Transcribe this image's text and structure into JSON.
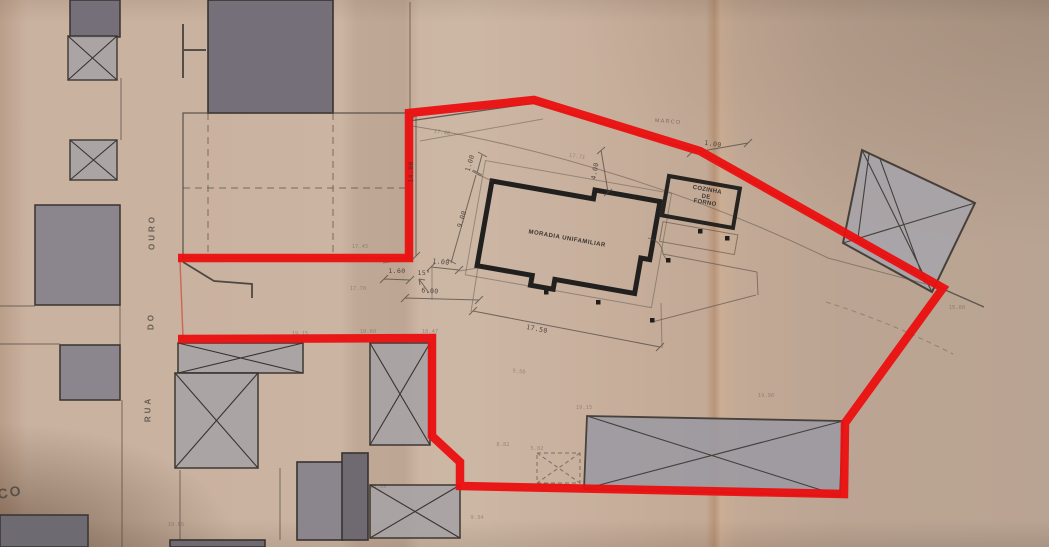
{
  "drawing": {
    "type": "site-plan-scan",
    "labels": {
      "main_building": "MORADIA UNIFAMILIAR",
      "annex": {
        "line1": "COZINHA",
        "line2": "DE",
        "line3": "FORNO"
      },
      "survey_marker": "MARCO",
      "street": {
        "word1": "OURO",
        "word2": "DO",
        "word3": "RUA",
        "partial": "CO"
      }
    },
    "dimensions": {
      "lot_depth": "14.00",
      "house_side": "9.00",
      "setback_top": "1.00",
      "setback_side": "1.00",
      "annex_setback": "1.00",
      "frontage_offset": "1.60",
      "boundary_angle": "15°",
      "front_setback": "6.00",
      "house_length": "17.50",
      "annex_gap": "4.00"
    },
    "faint_marks": [
      "17.40",
      "17.45",
      "17.70",
      "17.71",
      "9.56",
      "8.82",
      "5.02",
      "18.60",
      "18.47",
      "18.55",
      "19.15",
      "19.90",
      "19.15",
      "15.80",
      "19.65",
      "9.34"
    ],
    "colors": {
      "paper": "#c3aa96",
      "boundary_red": "#ea1111",
      "ink": "#4a423c",
      "wall_ink": "#21201e",
      "building_dark": "#746f78",
      "building_mid": "#8b868d",
      "building_light": "#a7a3a5",
      "pencil": "#3c352f"
    }
  }
}
